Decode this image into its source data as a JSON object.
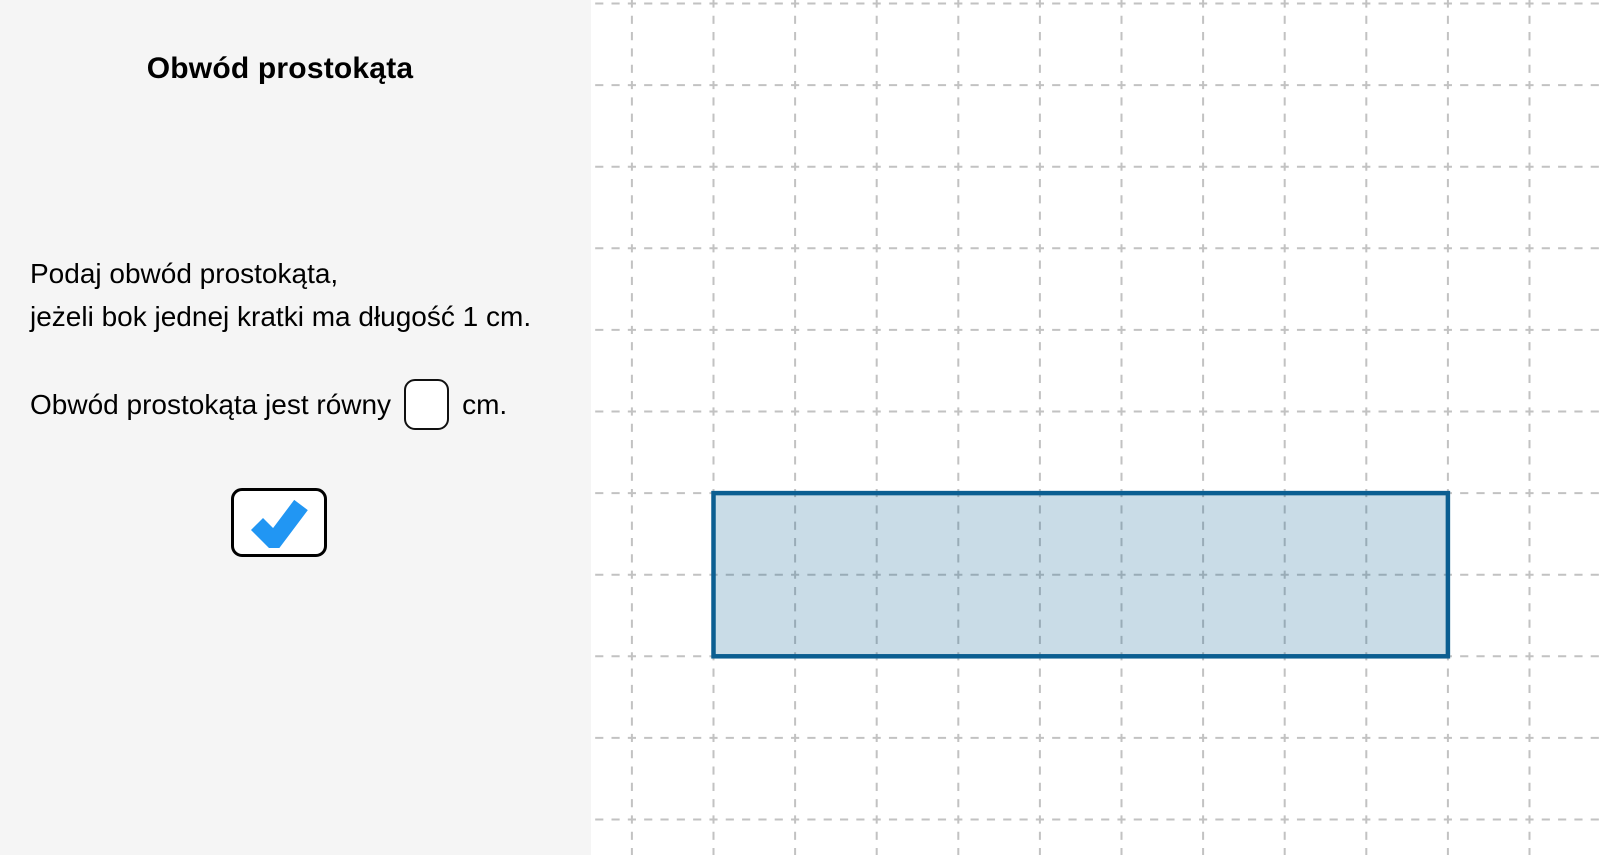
{
  "panel": {
    "title": "Obwód prostokąta",
    "instruction_line1": "Podaj obwód prostokąta,",
    "instruction_line2": "jeżeli bok jednej kratki ma długość 1 cm.",
    "answer_prompt": "Obwód prostokąta jest równy",
    "answer_value": "",
    "answer_unit": "cm.",
    "check_icon": "check-icon",
    "check_color": "#2196f3",
    "background": "#f5f5f5"
  },
  "board": {
    "background": "#ffffff",
    "grid": {
      "cell_px": 81.6,
      "offset_x": 40.9,
      "offset_y": 3.5,
      "line_color": "#c2c2c2",
      "line_width": 2,
      "dash_px": 8.16
    },
    "rectangle": {
      "left_cells": 1,
      "top_cells": 6,
      "width_cells": 9,
      "height_cells": 2,
      "width_cm": 9,
      "height_cm": 2,
      "fill": "rgba(11,94,145,0.22)",
      "stroke": "#0b5e91",
      "stroke_width": 4.5
    }
  }
}
